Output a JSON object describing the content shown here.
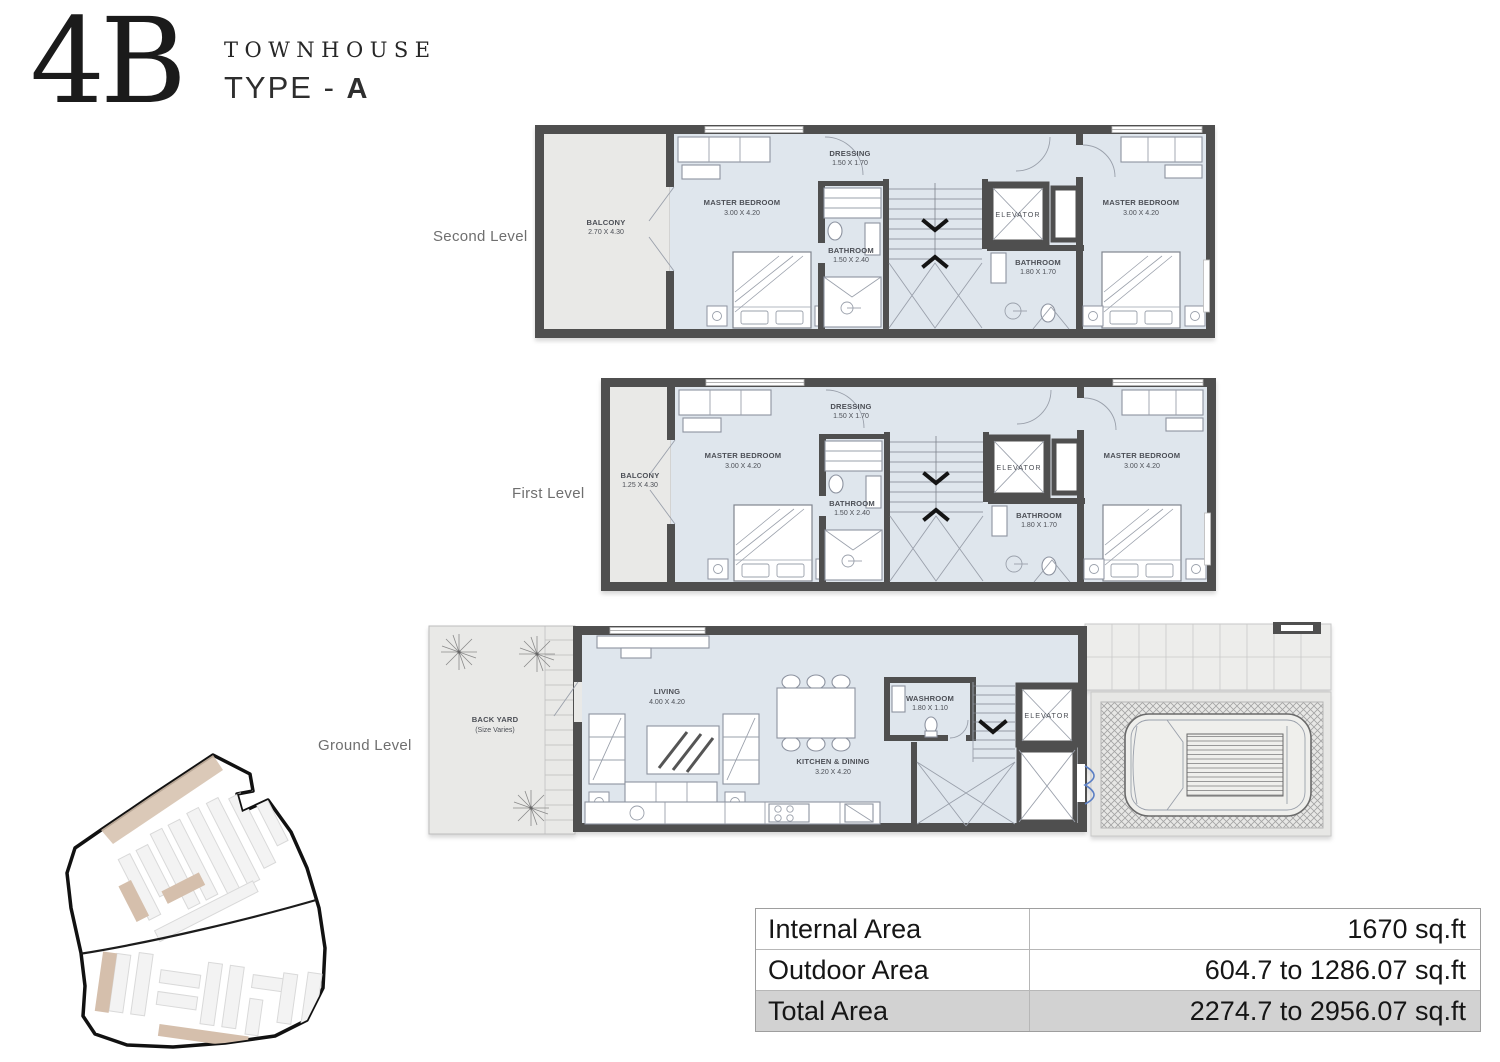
{
  "header": {
    "logo_number": "4B",
    "logo_title": "TOWNHOUSE",
    "logo_type_prefix": "TYPE - ",
    "logo_type_letter": "A"
  },
  "levels": {
    "second": {
      "label": "Second Level",
      "rooms": {
        "balcony": {
          "name": "BALCONY",
          "dims": "2.70 X 4.30"
        },
        "master_left": {
          "name": "MASTER BEDROOM",
          "dims": "3.00 X 4.20"
        },
        "dressing": {
          "name": "DRESSING",
          "dims": "1.50 X 1.70"
        },
        "bathroom_left": {
          "name": "BATHROOM",
          "dims": "1.50 X 2.40"
        },
        "elevator": {
          "name": "ELEVATOR"
        },
        "bathroom_right": {
          "name": "BATHROOM",
          "dims": "1.80 X 1.70"
        },
        "master_right": {
          "name": "MASTER BEDROOM",
          "dims": "3.00 X 4.20"
        }
      }
    },
    "first": {
      "label": "First Level",
      "rooms": {
        "balcony": {
          "name": "BALCONY",
          "dims": "1.25 X 4.30"
        },
        "master_left": {
          "name": "MASTER BEDROOM",
          "dims": "3.00 X 4.20"
        },
        "dressing": {
          "name": "DRESSING",
          "dims": "1.50 X 1.70"
        },
        "bathroom_left": {
          "name": "BATHROOM",
          "dims": "1.50 X 2.40"
        },
        "elevator": {
          "name": "ELEVATOR"
        },
        "bathroom_right": {
          "name": "BATHROOM",
          "dims": "1.80 X 1.70"
        },
        "master_right": {
          "name": "MASTER BEDROOM",
          "dims": "3.00 X 4.20"
        }
      }
    },
    "ground": {
      "label": "Ground Level",
      "rooms": {
        "backyard": {
          "name": "BACK YARD",
          "dims": "(Size Varies)"
        },
        "living": {
          "name": "LIVING",
          "dims": "4.00 X 4.20"
        },
        "kitchen": {
          "name": "KITCHEN & DINING",
          "dims": "3.20 X 4.20"
        },
        "washroom": {
          "name": "WASHROOM",
          "dims": "1.80 X 1.10"
        },
        "elevator": {
          "name": "ELEVATOR"
        }
      }
    }
  },
  "area_table": {
    "rows": [
      {
        "label": "Internal Area",
        "value": "1670 sq.ft"
      },
      {
        "label": "Outdoor Area",
        "value": "604.7 to 1286.07 sq.ft"
      },
      {
        "label": "Total Area",
        "value": "2274.7 to 2956.07 sq.ft"
      }
    ]
  },
  "colors": {
    "wall": "#4f4f4f",
    "room_fill": "#dfe6ed",
    "outdoor_fill": "#e9e9e7",
    "site_tan": "#d5bfac",
    "table_total_bg": "#d2d2d2",
    "door_accent": "#5b7fc4"
  }
}
